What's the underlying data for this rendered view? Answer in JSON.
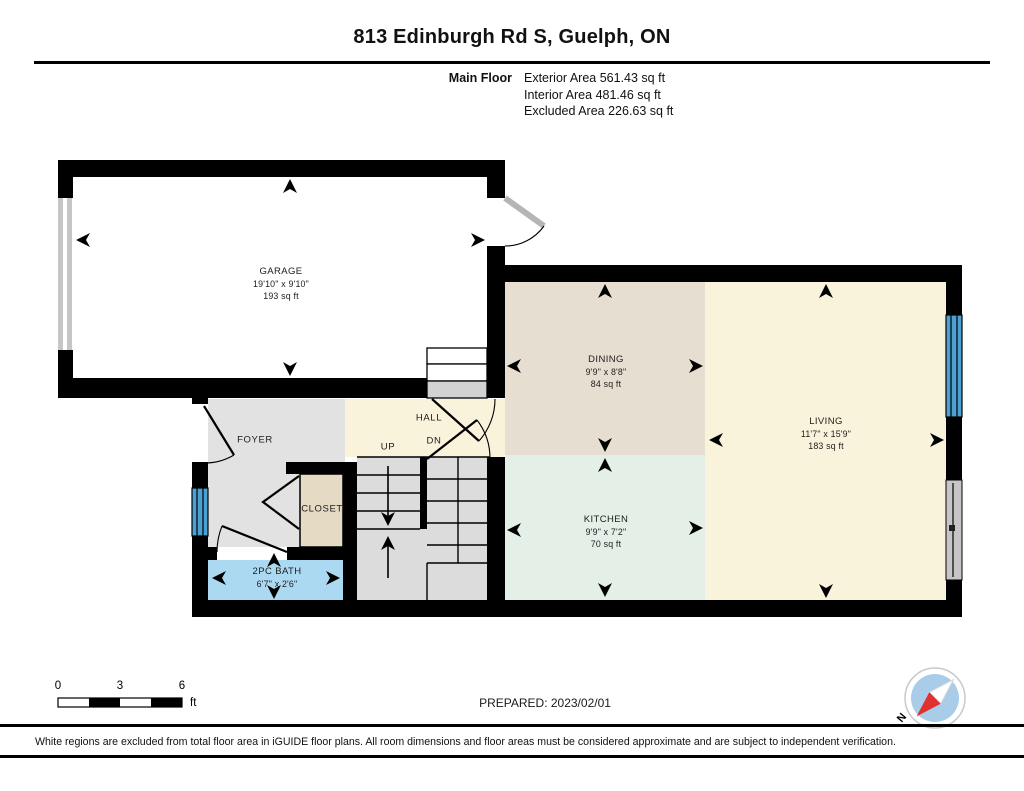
{
  "header": {
    "title": "813 Edinburgh Rd S, Guelph, ON",
    "floor_label": "Main Floor",
    "exterior_area": "Exterior Area 561.43 sq ft",
    "interior_area": "Interior Area 481.46 sq ft",
    "excluded_area": "Excluded Area 226.63 sq ft"
  },
  "rooms": {
    "garage": {
      "name": "GARAGE",
      "dims": "19'10\" x 9'10\"",
      "area": "193 sq ft"
    },
    "dining": {
      "name": "DINING",
      "dims": "9'9\" x 8'8\"",
      "area": "84 sq ft"
    },
    "living": {
      "name": "LIVING",
      "dims": "11'7\" x 15'9\"",
      "area": "183 sq ft"
    },
    "kitchen": {
      "name": "KITCHEN",
      "dims": "9'9\" x 7'2\"",
      "area": "70 sq ft"
    },
    "bath": {
      "name": "2PC BATH",
      "dims": "6'7\" x 2'6\""
    },
    "foyer": {
      "name": "FOYER"
    },
    "closet": {
      "name": "CLOSET"
    },
    "hall": {
      "name": "HALL"
    },
    "stairs": {
      "up": "UP",
      "dn": "DN"
    }
  },
  "scale_bar": {
    "ticks": [
      "0",
      "3",
      "6"
    ],
    "unit": "ft"
  },
  "prepared_label": "PREPARED: 2023/02/01",
  "compass": {
    "north_label": "N"
  },
  "footer": {
    "disclaimer": "White regions are excluded from total floor area in iGUIDE floor plans. All room dimensions and floor areas must be considered approximate and are subject to independent verification."
  },
  "colors": {
    "wall": "#000000",
    "dining": "#e6dfd1",
    "living": "#faf3dc",
    "kitchen": "#e4efe7",
    "bath": "#abd9f2",
    "foyer": "#e2e2e2",
    "stairs": "#dcdcdc",
    "closet": "#e5dac4",
    "window_blue": "#4da0d2",
    "door_gray": "#c6c6c6",
    "compass_red": "#e03030",
    "compass_disc": "#a9cce8"
  }
}
